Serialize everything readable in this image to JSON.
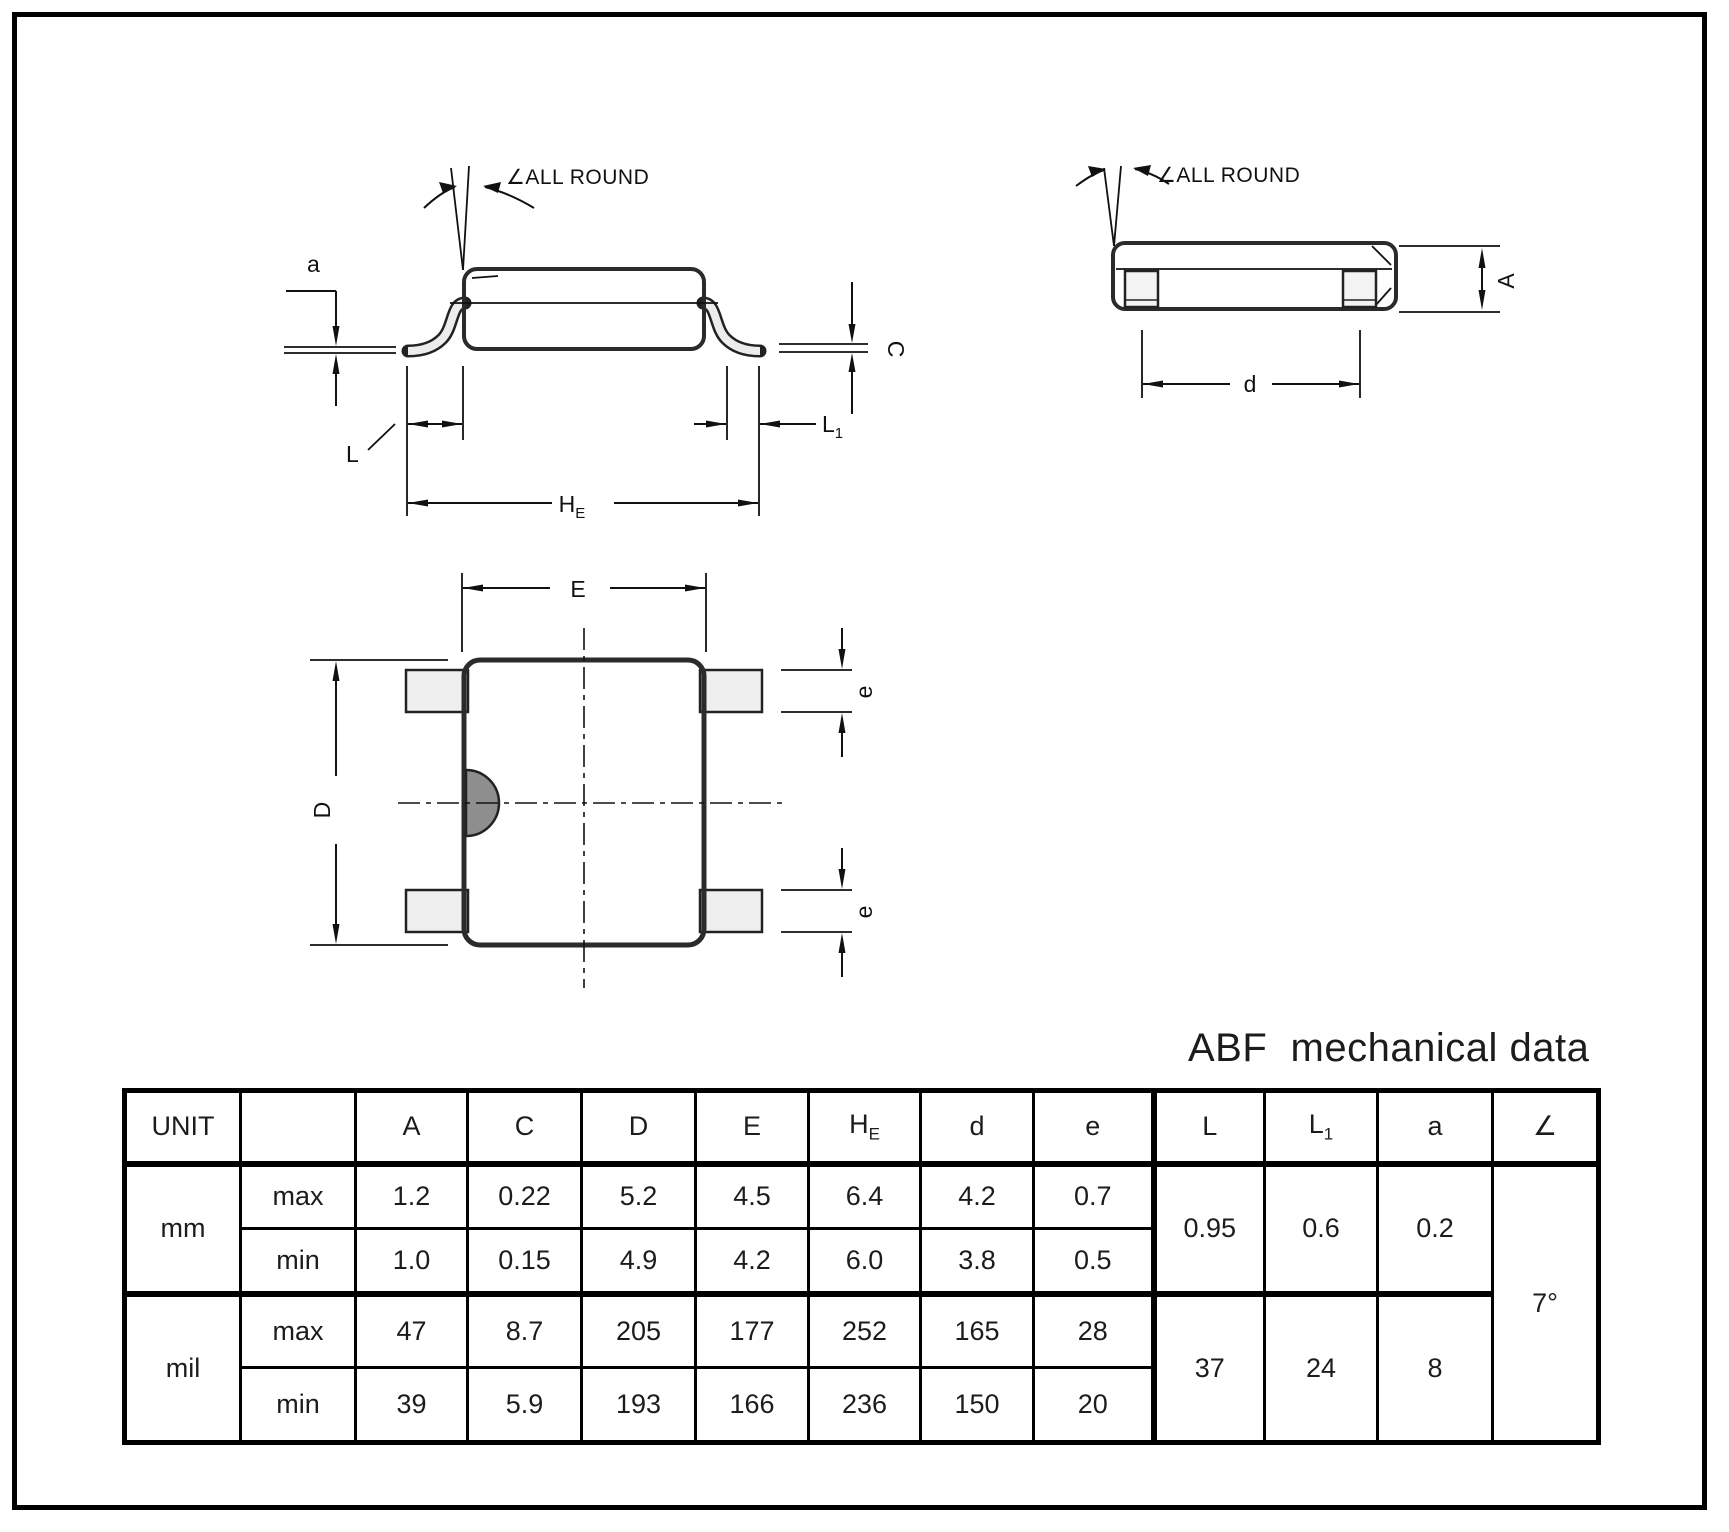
{
  "title": "ABF  mechanical data",
  "drawing": {
    "all_round": "∠ALL ROUND",
    "labels": {
      "a": "a",
      "c": "C",
      "l": "L",
      "l1_main": "L",
      "l1_sub": "1",
      "he_main": "H",
      "he_sub": "E",
      "d": "d",
      "height_a": "A",
      "width_e": "E",
      "depth_d": "D",
      "pitch_e": "e"
    }
  },
  "table": {
    "headers": {
      "unit": "UNIT",
      "blank": "",
      "a": "A",
      "c": "C",
      "d": "D",
      "e": "E",
      "he_main": "H",
      "he_sub": "E",
      "d_small": "d",
      "e_small": "e",
      "l": "L",
      "l1_main": "L",
      "l1_sub": "1",
      "a_small": "a",
      "angle": "∠"
    },
    "mm": {
      "label": "mm",
      "max_label": "max",
      "min_label": "min",
      "max": [
        "1.2",
        "0.22",
        "5.2",
        "4.5",
        "6.4",
        "4.2",
        "0.7"
      ],
      "min": [
        "1.0",
        "0.15",
        "4.9",
        "4.2",
        "6.0",
        "3.8",
        "0.5"
      ],
      "l": "0.95",
      "l1": "0.6",
      "a": "0.2"
    },
    "mil": {
      "label": "mil",
      "max_label": "max",
      "min_label": "min",
      "max": [
        "47",
        "8.7",
        "205",
        "177",
        "252",
        "165",
        "28"
      ],
      "min": [
        "39",
        "5.9",
        "193",
        "166",
        "236",
        "150",
        "20"
      ],
      "l": "37",
      "l1": "24",
      "a": "8"
    },
    "angle_value": "7°"
  },
  "colors": {
    "body": "#a8a8a8",
    "lead": "#ececec",
    "pad": "#f3f3f3",
    "notch": "#8e8e8e",
    "line": "#111111"
  }
}
